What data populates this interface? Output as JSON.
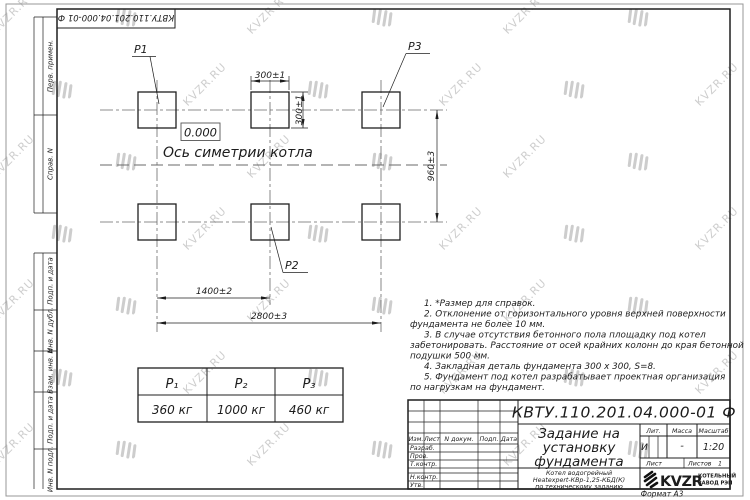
{
  "watermark": {
    "text": "KVZR.RU"
  },
  "margin_stamps": {
    "top_doc_number": "КВТУ.110.201.04.000-01 Ф",
    "left_labels": [
      "Перв. примен.",
      "Справ. N",
      "Подп. и дата",
      "Инв. N дубл.",
      "Взам. инв. N",
      "Подп. и дата",
      "Инв. N подл."
    ]
  },
  "drawing": {
    "point_labels": {
      "p1": "P1",
      "p2": "P2",
      "p3": "P3"
    },
    "elevation": "0.000",
    "axis_label": "Ось симетрии котла",
    "dimensions": {
      "width_top": "300±1",
      "height_right": "300±1",
      "vertical_span": "960±3",
      "mid_span": "1400±2",
      "full_span": "2800±3"
    }
  },
  "load_table": {
    "headers": [
      "Р₁",
      "Р₂",
      "Р₃"
    ],
    "values": [
      "360 кг",
      "1000 кг",
      "460 кг"
    ]
  },
  "notes": {
    "lines": [
      "1. *Размер для справок.",
      "2. Отклонение от горизонтального уровня верхней поверхности",
      "фундамента не более 10 мм.",
      "3. В случае отсутствия бетонного пола площадку под котел",
      "забетонировать. Расстояние от осей крайних колонн до края бетонной",
      "подушки 500 мм.",
      "4. Закладная деталь фундамента  300 х 300, S=8.",
      "5. Фундамент под котел разрабатывает проектная организация",
      "по нагрузкам на фундамент."
    ]
  },
  "title_block": {
    "doc_number": "КВТУ.110.201.04.000-01 Ф",
    "title_lines": [
      "Задание на",
      "установку",
      "фундамента"
    ],
    "subtitle_lines": [
      "Котел водогрейный",
      "Heatexpert-КВр-1,25-КБД(К)",
      "по техническому заданию"
    ],
    "header_cols": [
      "Изм.",
      "Лист",
      "N докум.",
      "Подп.",
      "Дата"
    ],
    "row_labels": [
      "Разраб.",
      "Пров.",
      "Т.контр.",
      "Н.контр.",
      "Утв."
    ],
    "lit_label": "Лит.",
    "mass_label": "Масса",
    "scale_label": "Масштаб",
    "lit_value": "И",
    "mass_value": "-",
    "scale_value": "1:20",
    "sheet_label": "Лист",
    "sheets_label": "Листов",
    "sheets_value": "1",
    "logo_text": "KVZR",
    "logo_line1": "КОТЕЛЬНЫЙ",
    "logo_line2": "ЗАВОД РЭП",
    "format_label": "Формат А3"
  },
  "colors": {
    "line": "#1f1f1f",
    "watermark": "#a6a6a6",
    "paper": "#ffffff"
  }
}
